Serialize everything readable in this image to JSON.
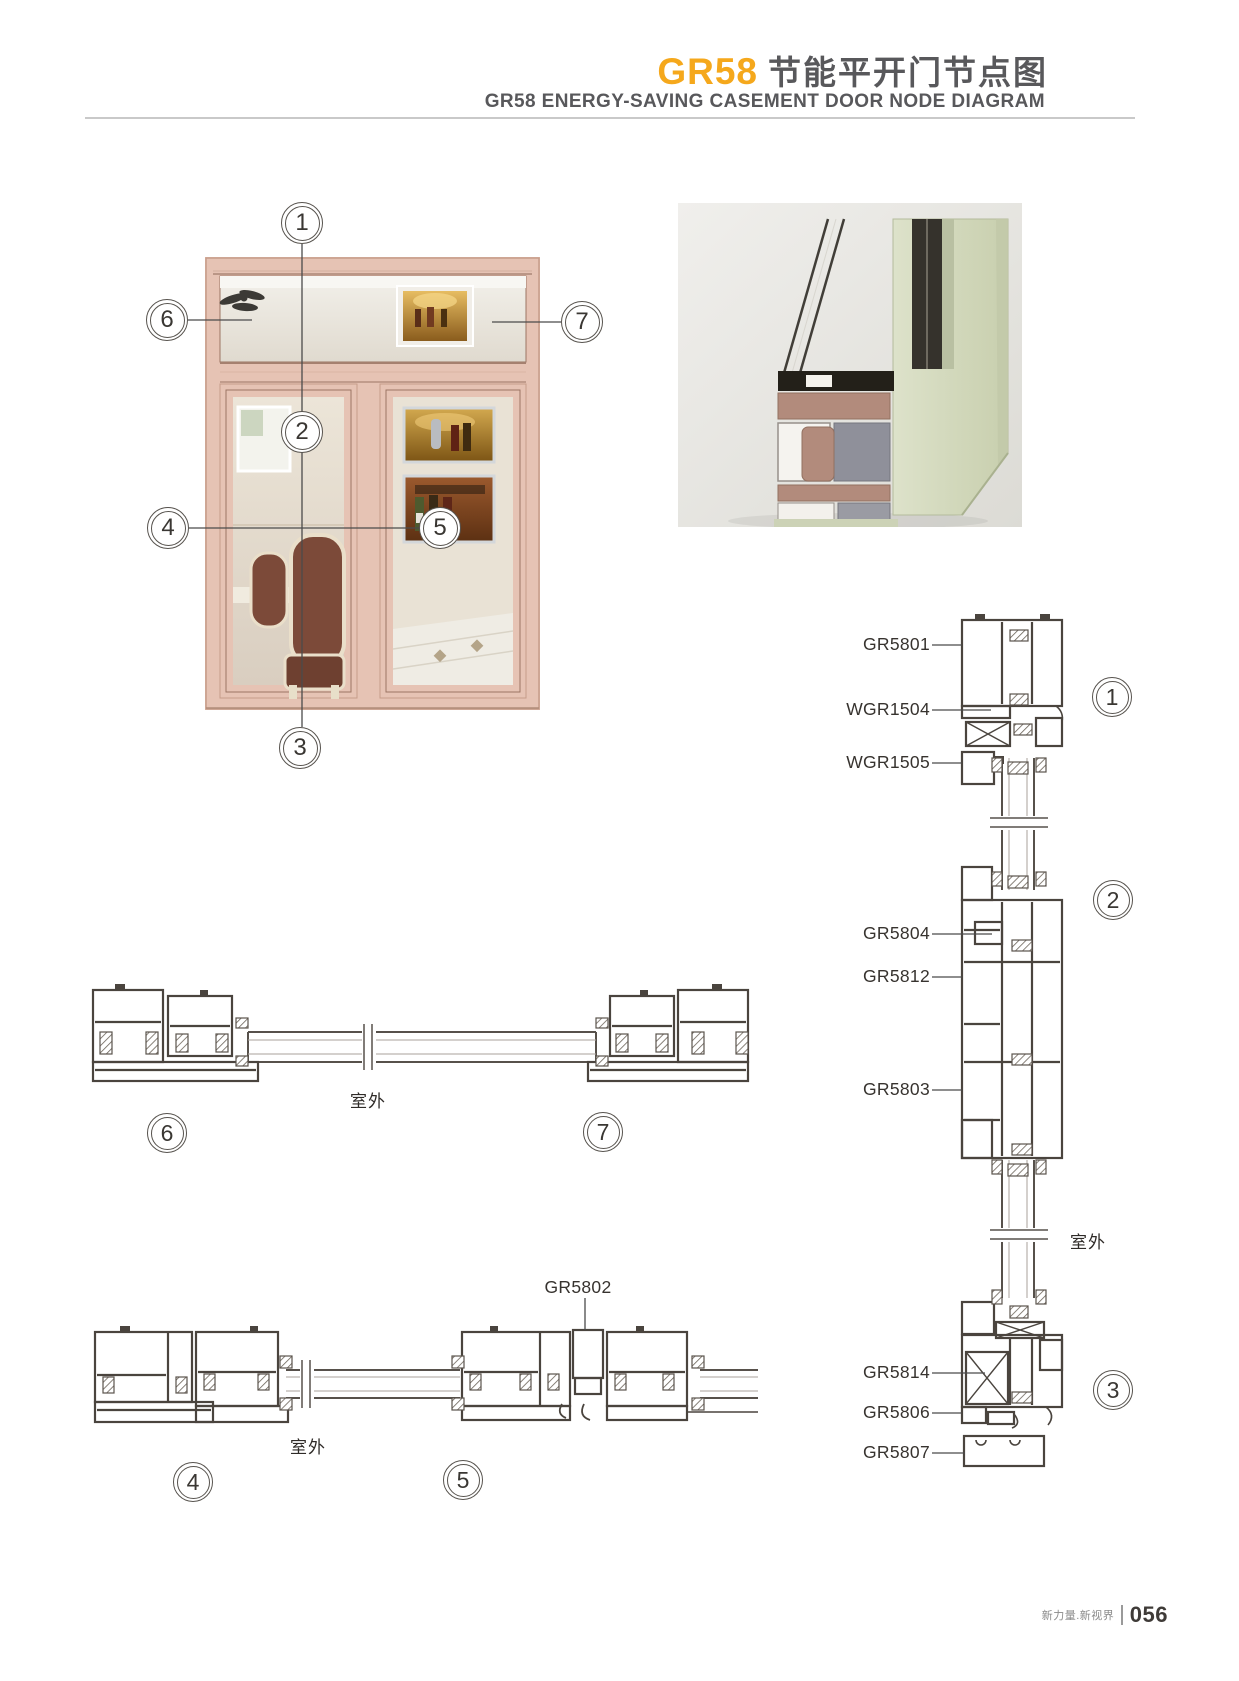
{
  "header": {
    "title_code": "GR58",
    "title_zh": "节能平开门节点图",
    "subtitle": "GR58 ENERGY-SAVING CASEMENT DOOR NODE DIAGRAM"
  },
  "photo": {
    "callouts": [
      "1",
      "2",
      "3",
      "4",
      "5",
      "6",
      "7"
    ]
  },
  "sections": {
    "right_vertical": {
      "labels": [
        "GR5801",
        "WGR1504",
        "WGR1505",
        "GR5804",
        "GR5812",
        "GR5803",
        "GR5814",
        "GR5806",
        "GR5807"
      ],
      "callouts": [
        "1",
        "2",
        "3"
      ],
      "outdoor_label": "室外"
    },
    "mid_horizontal": {
      "callouts": [
        "6",
        "7"
      ],
      "outdoor_label": "室外"
    },
    "bottom_horizontal": {
      "labels": [
        "GR5802"
      ],
      "callouts": [
        "4",
        "5"
      ],
      "outdoor_label": "室外"
    }
  },
  "footer": {
    "slogan": "新力量.新视界",
    "page_number": "056"
  },
  "colors": {
    "accent_orange": "#F5A81C",
    "heading_gray": "#58585B",
    "frame_pink": "#E6C3B4",
    "profile_sage": "#D5DAC1",
    "drawing_line": "#4A443E"
  }
}
